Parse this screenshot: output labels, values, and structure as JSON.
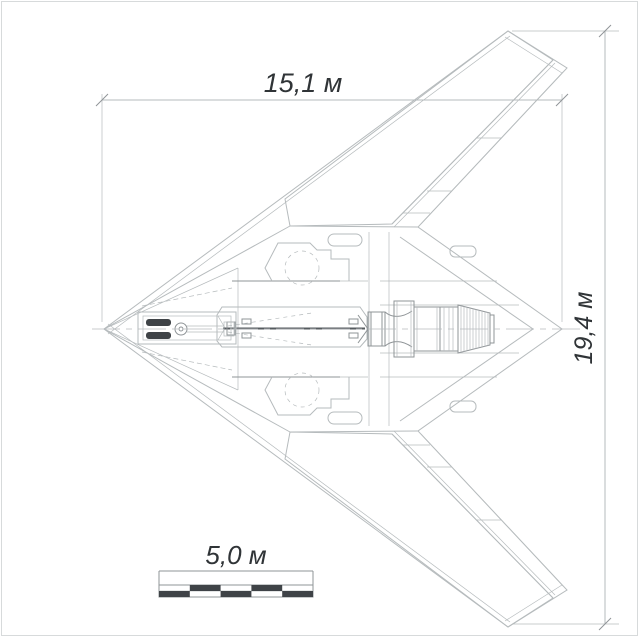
{
  "palette": {
    "bg": "#ffffff",
    "line": "#b6bbbd",
    "line_strong": "#8f9497",
    "spine": "#565b5f",
    "dark_fill": "#3f4347",
    "text": "#303437",
    "frame": "#d7dadb"
  },
  "dimensions": {
    "length": {
      "label": "15,1 м"
    },
    "span": {
      "label": "19,4 м"
    }
  },
  "scale_bar": {
    "label": "5,0 м",
    "segments": 5
  }
}
